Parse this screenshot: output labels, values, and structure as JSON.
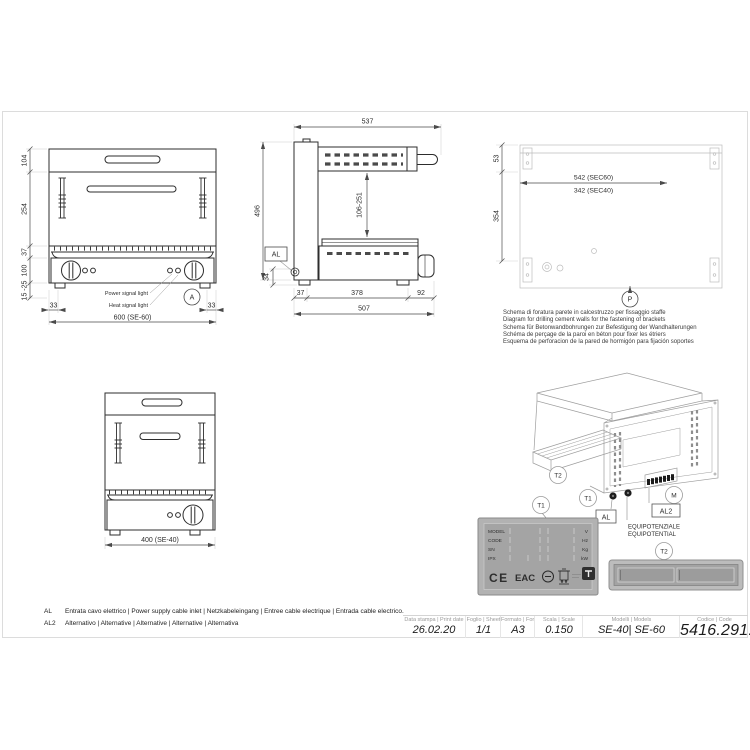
{
  "doc": {
    "front60": {
      "d104": "104",
      "d254": "254",
      "d37": "37",
      "d100": "100",
      "d15_25": "15 -25",
      "d33l": "33",
      "d33r": "33",
      "d600": "600 (SE-60)",
      "power_light": "Power signal light",
      "heat_light": "Heat signal light",
      "detail_a": "A"
    },
    "side": {
      "d537": "537",
      "d496": "496",
      "d106_251": "106-251",
      "d34": "34",
      "d37": "37",
      "d378": "378",
      "d92": "92",
      "d507": "507",
      "al": "AL"
    },
    "plan": {
      "d53": "53",
      "d354": "354",
      "d542": "542 (SEC60)",
      "d342": "342 (SEC40)",
      "p": "P"
    },
    "drill_note": {
      "it": "Schema di foratura parete in calcestruzzo per fissaggio staffe",
      "en": "Diagram for drilling cement walls for the fastening of brackets",
      "de": "Schema für Betonwandbohrungen zur Befestigung der Wandhalterungen",
      "fr": "Schéma de perçage de la paroi en béton pour fixer les étriers",
      "es": "Esquema de perforacion de la pared de hormigón para fijación soportes"
    },
    "front40": {
      "d400": "400 (SE-40)"
    },
    "iso": {
      "t2_top": "T2",
      "t1_right": "T1",
      "t1_left": "T1",
      "m": "M",
      "al": "AL",
      "al2": "AL2",
      "equip_it": "EQUIPOTENZIALE",
      "equip_en": "EQUIPOTENTIAL",
      "t2_bottom": "T2"
    },
    "plate": {
      "row1": "MODEL",
      "row2": "CODE",
      "row3": "SN",
      "row4": "IPX",
      "u1": "V",
      "u2": "Hz",
      "u3": "Kg",
      "u4": "kW",
      "ce": "CE",
      "eac": "EAC"
    },
    "notes": {
      "al_key": "AL",
      "al_text": "Entrata cavo elettrico | Power supply cable inlet | Netzkabeleingang | Entree cable electrique | Entrada cable electrico.",
      "al2_key": "AL2",
      "al2_text": "Alternativo | Alternative | Alternative | Alternative | Alternativa"
    },
    "titleblock": {
      "print_date_label": "Data stampa | Print date",
      "print_date": "26.02.20",
      "sheet_label": "Foglio | Sheet",
      "sheet": "1/1",
      "format_label": "Formato | Format",
      "format": "A3",
      "scale_label": "Scala | Scale",
      "scale": "0.150",
      "models_label": "Modelli | Models",
      "models": "SE-40| SE-60",
      "code_label": "Codice | Code",
      "code": "5416.291.00"
    },
    "icons": [
      "ce-mark",
      "eac-mark",
      "certification-mark-icon",
      "weee-bin-icon",
      "brand-logo-icon"
    ],
    "colors": {
      "line": "#2d2d2d",
      "dim": "#4a4a4a",
      "light_line": "#bdbdbd",
      "plate_bg": "#b2b2b2"
    }
  }
}
